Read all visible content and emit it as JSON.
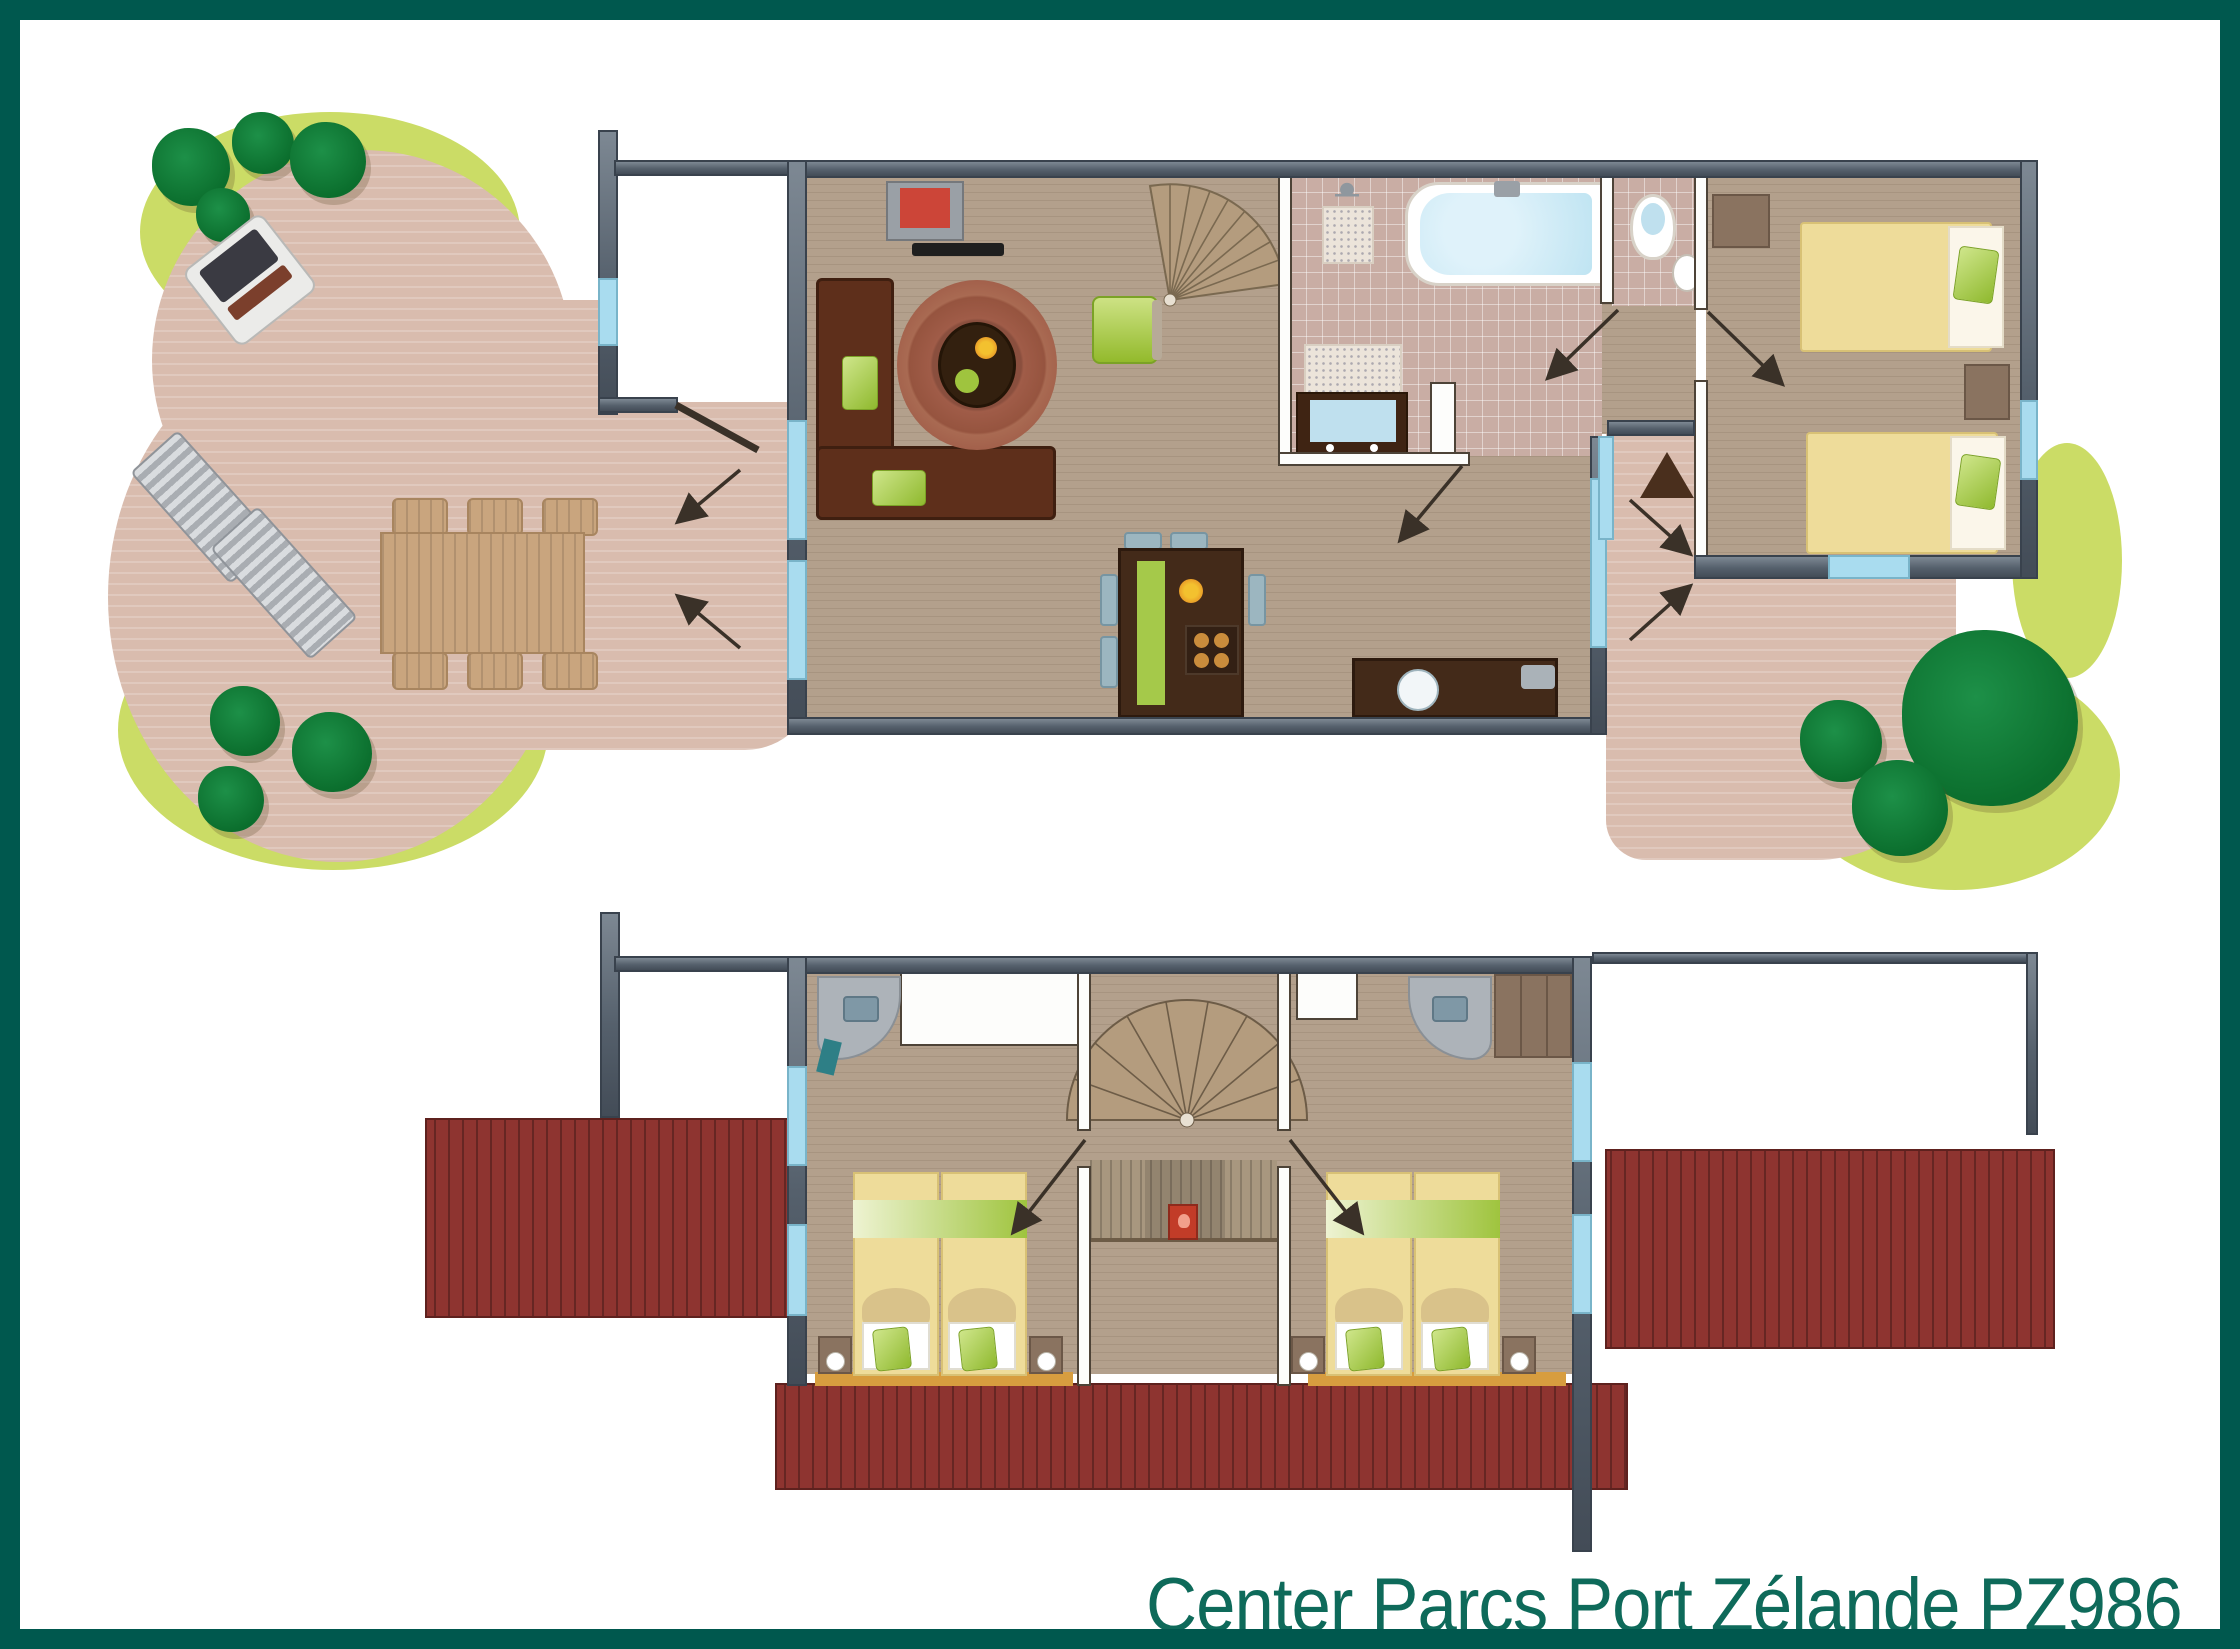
{
  "caption": {
    "text": "Center Parcs Port Zélande PZ986"
  },
  "colors": {
    "border": "#00584e",
    "caption_text": "#0e6a5a",
    "wall_gray": "#55606c",
    "window_blue": "#a9dcef",
    "wood_floor": "#b3a08c",
    "bathroom_tile": "#c9ada4",
    "patio_pink": "#d9bcae",
    "deck_red": "#8e3430",
    "grass_green": "#cbdc66",
    "bush_green": "#0b6e2d",
    "bed_yellow": "#eedc9a",
    "bed_stripe_green": "#9fc43e",
    "sofa_brown": "#5e2f1b",
    "cabinet_brown": "#432a19",
    "stair_tan": "#b49c7e",
    "fire_box_red": "#c23c28",
    "threshold_orange": "#d79d3f",
    "tv_screen_red": "#cc4538",
    "water_blue": "#bfe4f2"
  },
  "plans": [
    {
      "name": "ground-floor",
      "features": [
        "garden-terrace",
        "bushes",
        "grass",
        "bbq",
        "lounge-chairs",
        "outdoor-dining-table",
        "storage-shed",
        "living-room",
        "tv",
        "corner-sofa",
        "rug",
        "coffee-table",
        "armchair",
        "spiral-staircase",
        "kitchen-island",
        "stove",
        "kitchen-counter",
        "sink",
        "bathroom",
        "shower",
        "bathtub",
        "vanity",
        "toilet",
        "hallway",
        "entrance-arrow",
        "bedroom-twin-beds",
        "wardrobe",
        "rear-terrace"
      ]
    },
    {
      "name": "first-floor",
      "features": [
        "railing",
        "fence",
        "left-deck",
        "right-deck",
        "bottom-deck",
        "spiral-staircase",
        "landing",
        "fire-extinguisher-box",
        "bedroom-left-double-bed",
        "bedroom-right-double-bed",
        "washbasins",
        "closets",
        "nightstands",
        "lamps"
      ]
    }
  ],
  "icons": [
    "shower-icon",
    "toilet-icon",
    "sink-icon",
    "entrance-triangle-icon",
    "door-swing-icon",
    "spiral-staircase-icon",
    "fire-extinguisher-icon",
    "bed-icon",
    "lamp-icon"
  ]
}
